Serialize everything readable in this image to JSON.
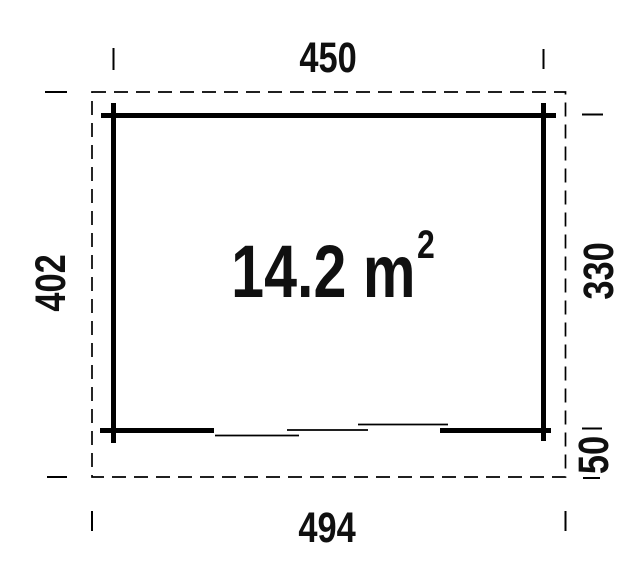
{
  "floor_plan": {
    "area_label": {
      "text": "14.2 m",
      "superscript": "2"
    },
    "dimensions": {
      "top_width": "450",
      "bottom_width": "494",
      "left_depth": "402",
      "right_inner_depth": "330",
      "right_overhang": "50"
    },
    "colors": {
      "line": "#000000",
      "text": "#101010",
      "background": "#ffffff"
    }
  }
}
